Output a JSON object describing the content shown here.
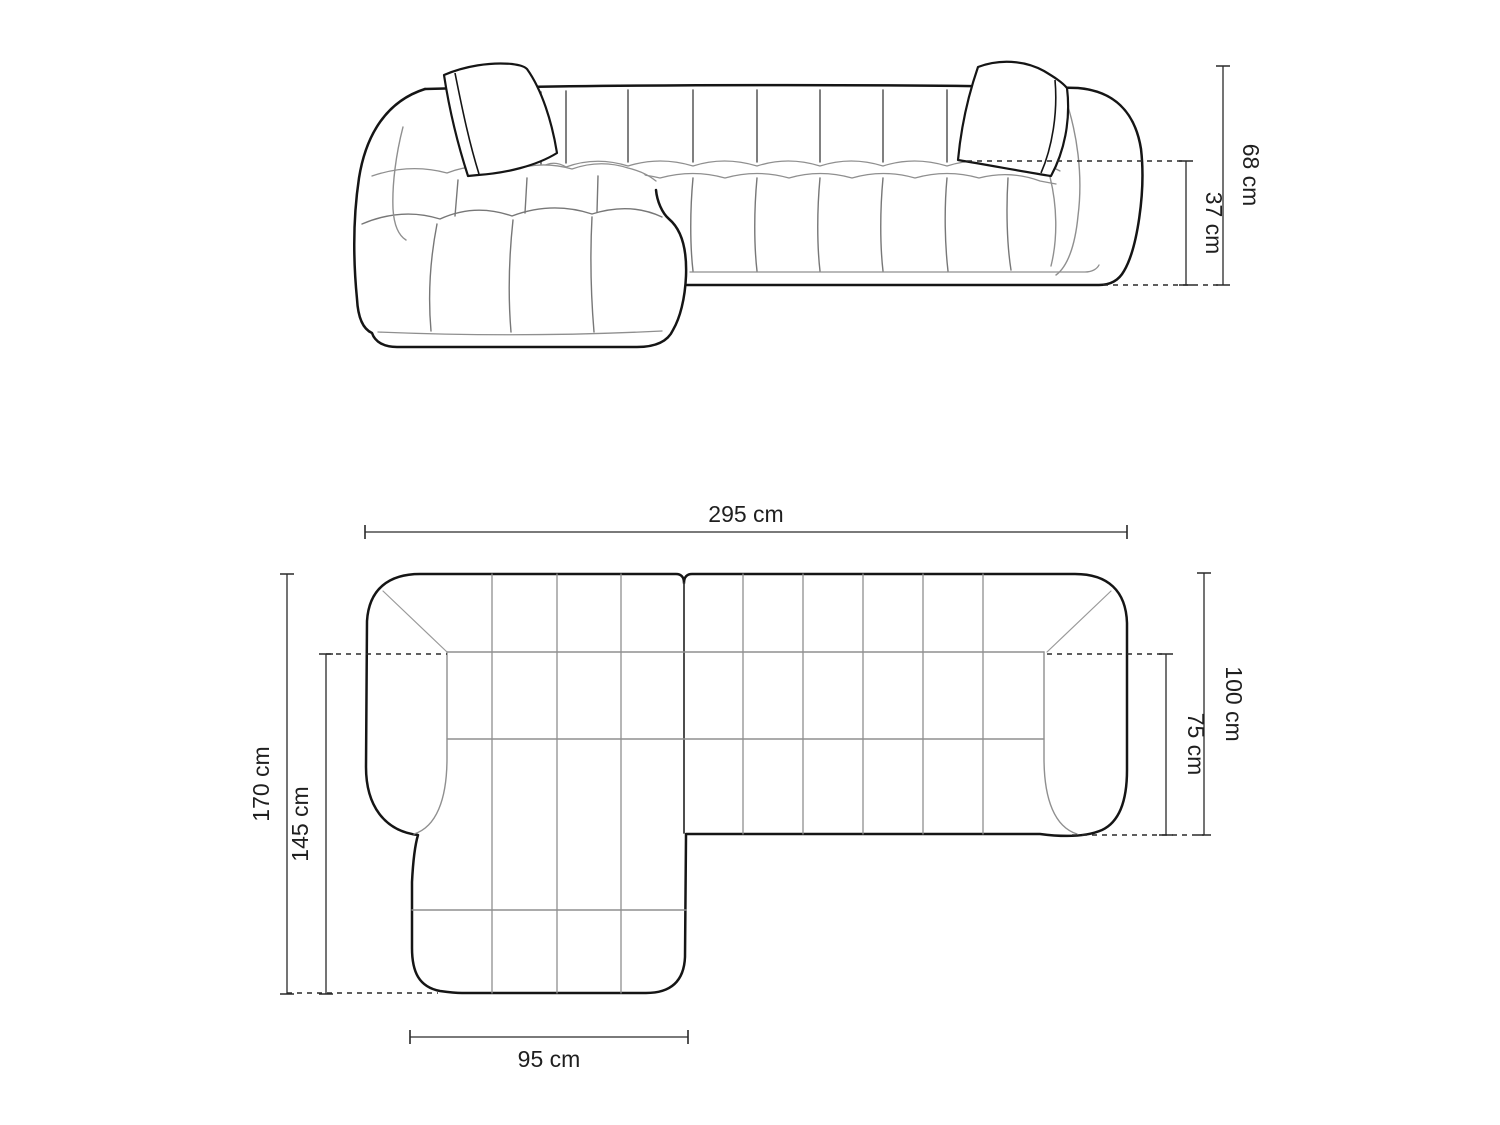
{
  "colors": {
    "background": "#ffffff",
    "outline": "#151515",
    "seam_light": "#8f8f8f",
    "seam_dark": "#4a4a4a",
    "dimension": "#2a2a2a",
    "text": "#1f1f1f"
  },
  "front_view": {
    "dimensions": {
      "total_height": {
        "label": "68 cm",
        "value": 68,
        "unit": "cm"
      },
      "seat_height": {
        "label": "37 cm",
        "value": 37,
        "unit": "cm"
      }
    }
  },
  "plan_view": {
    "dimensions": {
      "total_width": {
        "label": "295 cm",
        "value": 295,
        "unit": "cm"
      },
      "total_depth": {
        "label": "170 cm",
        "value": 170,
        "unit": "cm"
      },
      "chaise_depth": {
        "label": "145 cm",
        "value": 145,
        "unit": "cm"
      },
      "body_depth": {
        "label": "100 cm",
        "value": 100,
        "unit": "cm"
      },
      "seat_depth": {
        "label": "75 cm",
        "value": 75,
        "unit": "cm"
      },
      "chaise_width": {
        "label": "95 cm",
        "value": 95,
        "unit": "cm"
      }
    }
  }
}
